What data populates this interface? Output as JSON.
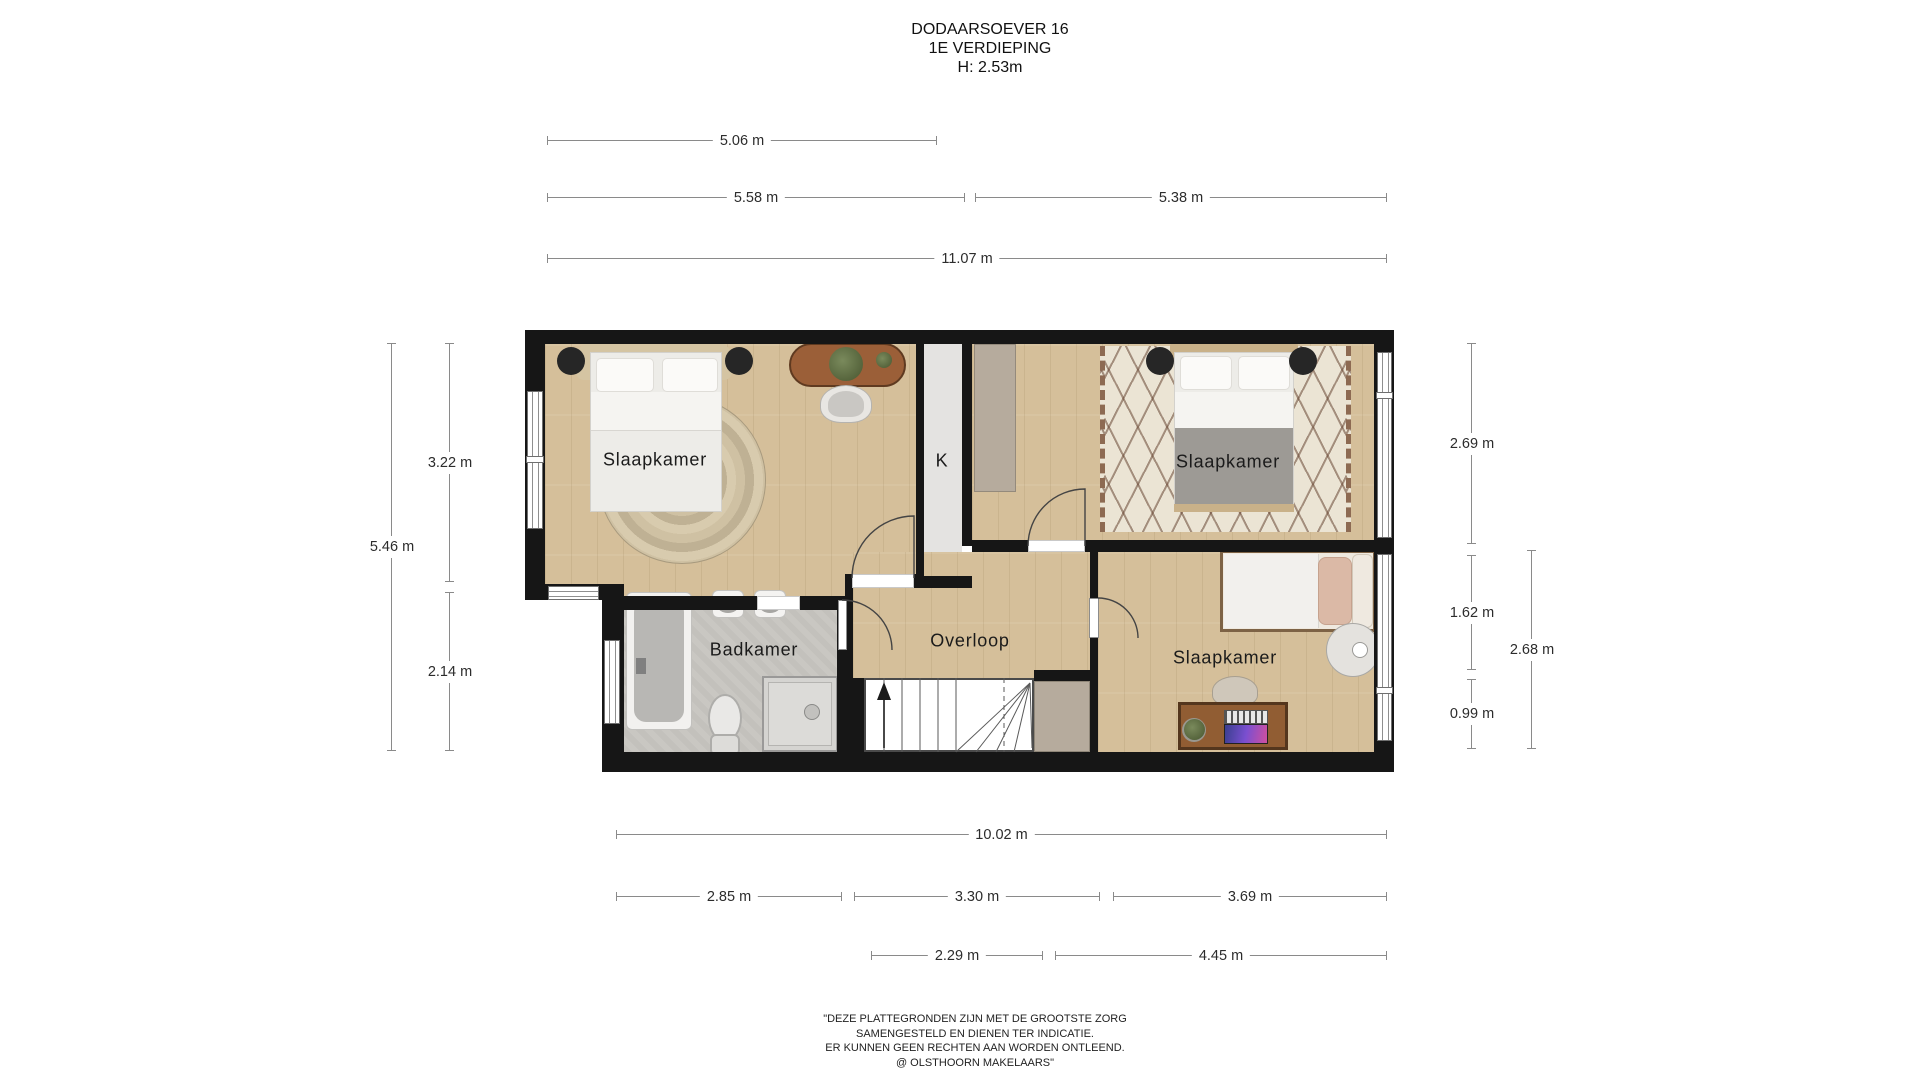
{
  "title": {
    "line1": "DODAARSOEVER 16",
    "line2": "1E VERDIEPING",
    "line3": "H: 2.53m"
  },
  "rooms": {
    "bedroom_left": "Slaapkamer",
    "bedroom_right": "Slaapkamer",
    "bedroom_bottom": "Slaapkamer",
    "bathroom": "Badkamer",
    "landing": "Overloop",
    "closet": "K"
  },
  "dims": {
    "d506": {
      "label": "5.06 m"
    },
    "d558": {
      "label": "5.58 m"
    },
    "d538": {
      "label": "5.38 m"
    },
    "d1107": {
      "label": "11.07 m"
    },
    "d322": {
      "label": "3.22 m"
    },
    "d546": {
      "label": "5.46 m"
    },
    "d214": {
      "label": "2.14 m"
    },
    "d269": {
      "label": "2.69 m"
    },
    "d162": {
      "label": "1.62 m"
    },
    "d099": {
      "label": "0.99 m"
    },
    "d268": {
      "label": "2.68 m"
    },
    "d1002": {
      "label": "10.02 m"
    },
    "d285": {
      "label": "2.85 m"
    },
    "d330": {
      "label": "3.30 m"
    },
    "d369": {
      "label": "3.69 m"
    },
    "d229": {
      "label": "2.29 m"
    },
    "d445": {
      "label": "4.45 m"
    }
  },
  "disclaimer": {
    "line1": "\"DEZE PLATTEGRONDEN ZIJN MET DE GROOTSTE ZORG",
    "line2": "SAMENGESTELD EN DIENEN TER INDICATIE.",
    "line3": "ER KUNNEN GEEN RECHTEN AAN WORDEN ONTLEEND.",
    "line4": "@ OLSTHOORN MAKELAARS\""
  },
  "colors": {
    "wall": "#161616",
    "wood_floor": "#d5bf9a",
    "bathroom_floor": "#c9c7c2",
    "closet_floor": "#e4e3e1",
    "wardrobe": "#b6ab9d",
    "rug_pattern": "#684634",
    "dimension_line": "#8a8a8a",
    "text": "#1d1d1d"
  }
}
